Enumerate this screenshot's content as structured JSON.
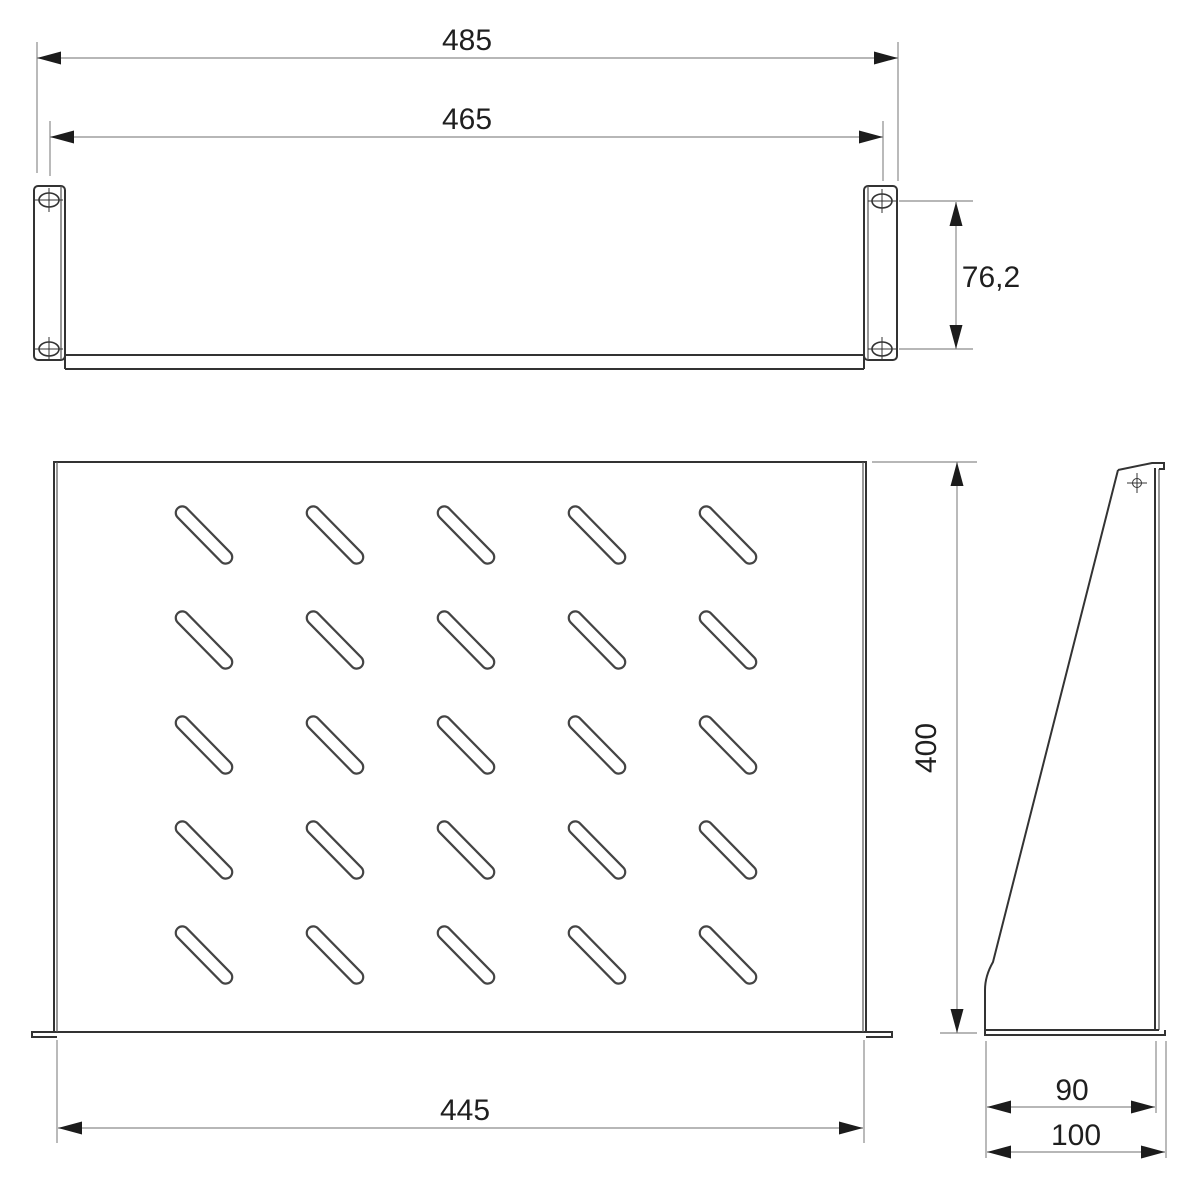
{
  "drawing": {
    "kind": "rack-shelf-technical-drawing",
    "views": {
      "front_view": "front elevation with mounting ears",
      "plan_view": "shelf plate with ventilation slots",
      "side_view": "side bracket profile"
    },
    "dimensions": {
      "front_overall_width": "485",
      "front_hole_span": "465",
      "front_panel_height": "76,2",
      "shelf_width": "445",
      "shelf_depth": "400",
      "side_depth_face": "90",
      "side_depth_overall": "100"
    },
    "plate": {
      "slot_rows": 5,
      "slot_cols": 5,
      "slot_angle_deg": 45.5,
      "col_start_x": 204,
      "col_step_x": 131,
      "row_start_y": 535,
      "row_step_y": 105,
      "slot_length": 75,
      "slot_width": 13
    },
    "icons": {
      "screw_slot_hole": "oval hole with crosshair",
      "center_mark": "circle with cross ticks"
    },
    "colors": {
      "object_line": "#333333",
      "thin_line": "#555555",
      "dim_line": "#8c8c8c",
      "arrow": "#1c1c1c",
      "text": "#1f1f1f",
      "background": "#ffffff"
    }
  }
}
